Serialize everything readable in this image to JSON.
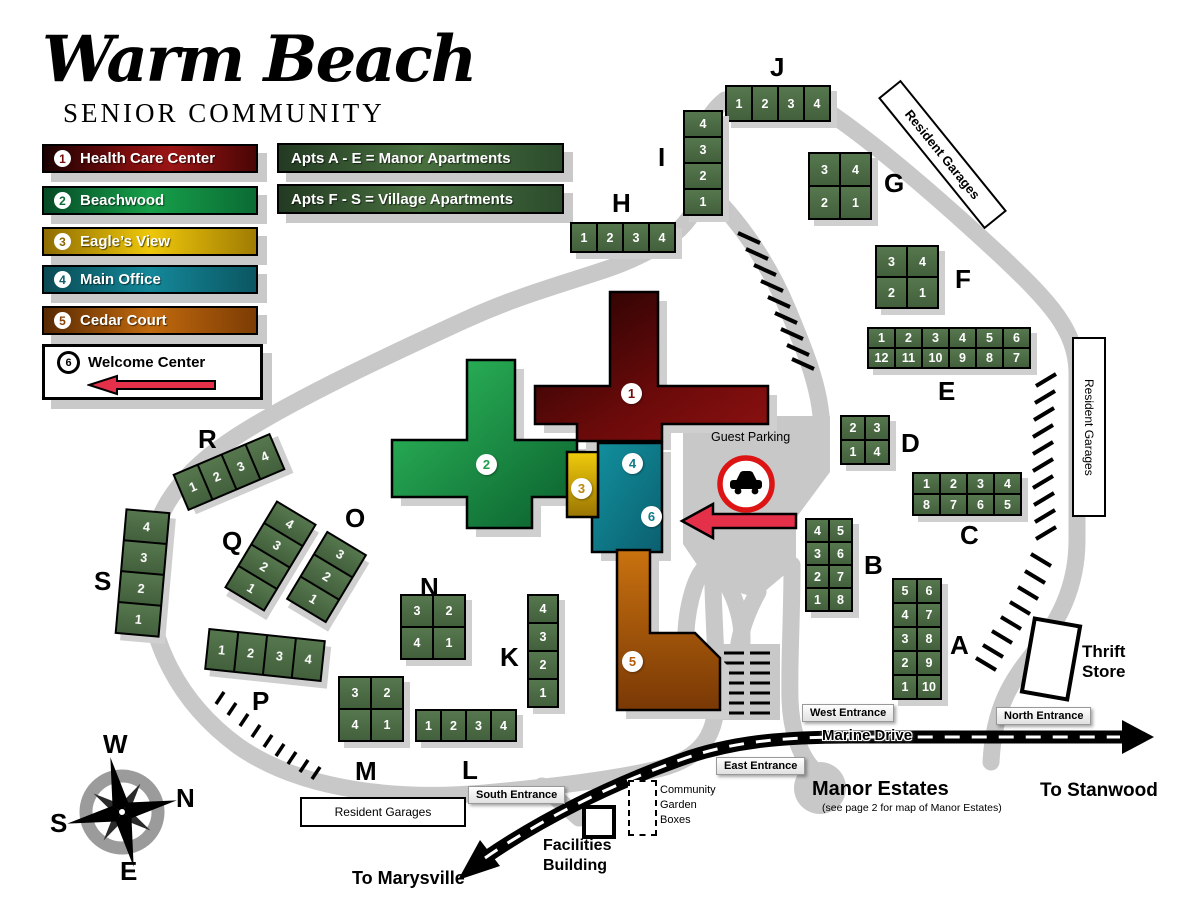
{
  "logo": {
    "title": "Warm Beach",
    "subtitle": "SENIOR COMMUNITY"
  },
  "legend": {
    "items": [
      {
        "num": "1",
        "label": "Health Care Center",
        "color": "#7a0b0b"
      },
      {
        "num": "2",
        "label": "Beachwood",
        "color": "#17a04a"
      },
      {
        "num": "3",
        "label": "Eagle’s View",
        "color": "#b8860b"
      },
      {
        "num": "4",
        "label": "Main Office",
        "color": "#0f7b8a"
      },
      {
        "num": "5",
        "label": "Cedar Court",
        "color": "#b35c0b"
      },
      {
        "num": "6",
        "label": "Welcome Center",
        "color": "#000000"
      }
    ]
  },
  "apt_keys": [
    {
      "text": "Apts A - E =  Manor Apartments"
    },
    {
      "text": "Apts F - S =  Village Apartments"
    }
  ],
  "buildings": {
    "A": {
      "letter": "A",
      "rows": [
        [
          "5",
          "6"
        ],
        [
          "4",
          "7"
        ],
        [
          "3",
          "8"
        ],
        [
          "2",
          "9"
        ],
        [
          "1",
          "10"
        ]
      ]
    },
    "B": {
      "letter": "B",
      "rows": [
        [
          "4",
          "5"
        ],
        [
          "3",
          "6"
        ],
        [
          "2",
          "7"
        ],
        [
          "1",
          "8"
        ]
      ]
    },
    "C": {
      "letter": "C",
      "rows": [
        [
          "1",
          "2",
          "3",
          "4"
        ],
        [
          "8",
          "7",
          "6",
          "5"
        ]
      ]
    },
    "D": {
      "letter": "D",
      "rows": [
        [
          "2",
          "3"
        ],
        [
          "1",
          "4"
        ]
      ]
    },
    "E": {
      "letter": "E",
      "rows": [
        [
          "1",
          "2",
          "3",
          "4",
          "5",
          "6"
        ],
        [
          "12",
          "11",
          "10",
          "9",
          "8",
          "7"
        ]
      ]
    },
    "F": {
      "letter": "F",
      "rows": [
        [
          "3",
          "4"
        ],
        [
          "2",
          "1"
        ]
      ]
    },
    "G": {
      "letter": "G",
      "rows": [
        [
          "3",
          "4"
        ],
        [
          "2",
          "1"
        ]
      ]
    },
    "H": {
      "letter": "H",
      "rows": [
        [
          "1",
          "2",
          "3",
          "4"
        ]
      ]
    },
    "I": {
      "letter": "I",
      "rows": [
        [
          "4"
        ],
        [
          "3"
        ],
        [
          "2"
        ],
        [
          "1"
        ]
      ]
    },
    "J": {
      "letter": "J",
      "rows": [
        [
          "1",
          "2",
          "3",
          "4"
        ]
      ]
    },
    "K": {
      "letter": "K",
      "rows": [
        [
          "4"
        ],
        [
          "3"
        ],
        [
          "2"
        ],
        [
          "1"
        ]
      ]
    },
    "L": {
      "letter": "L",
      "rows": [
        [
          "1",
          "2",
          "3",
          "4"
        ]
      ]
    },
    "M": {
      "letter": "M",
      "rows": [
        [
          "3",
          "2"
        ],
        [
          "4",
          "1"
        ]
      ]
    },
    "N": {
      "letter": "N",
      "rows": [
        [
          "3",
          "2"
        ],
        [
          "4",
          "1"
        ]
      ]
    },
    "O": {
      "letter": "O",
      "rows": [
        [
          "3"
        ],
        [
          "2"
        ],
        [
          "1"
        ]
      ]
    },
    "P": {
      "letter": "P",
      "rows": [
        [
          "1",
          "2",
          "3",
          "4"
        ]
      ]
    },
    "Q": {
      "letter": "Q",
      "rows": [
        [
          "4"
        ],
        [
          "3"
        ],
        [
          "2"
        ],
        [
          "1"
        ]
      ]
    },
    "R": {
      "letter": "R",
      "rows": [
        [
          "1",
          "2",
          "3",
          "4"
        ]
      ]
    },
    "S": {
      "letter": "S",
      "rows": [
        [
          "4"
        ],
        [
          "3"
        ],
        [
          "2"
        ],
        [
          "1"
        ]
      ]
    }
  },
  "markers": [
    {
      "num": "1",
      "color": "#7a0b0b"
    },
    {
      "num": "2",
      "color": "#1d9e4b"
    },
    {
      "num": "3",
      "color": "#b8860b"
    },
    {
      "num": "4",
      "color": "#0f7b8a"
    },
    {
      "num": "5",
      "color": "#b35c0b"
    },
    {
      "num": "6",
      "color": "#0f7b8a"
    }
  ],
  "map_labels": {
    "guest_parking": "Guest Parking",
    "resident_garages_top": "Resident Garages",
    "resident_garages_right": "Resident Garages",
    "resident_garages_bottom": "Resident Garages",
    "thrift_store": [
      "Thrift",
      "Store"
    ],
    "marine_drive": "Marine Drive",
    "manor_estates": "Manor Estates",
    "manor_estates_note": "(see page 2 for map of Manor Estates)",
    "to_stanwood": "To Stanwood",
    "to_marysville": "To Marysville",
    "facilities_building": [
      "Facilities",
      "Building"
    ],
    "community_garden": [
      "Community",
      "Garden",
      "Boxes"
    ]
  },
  "entrances": {
    "south": "South Entrance",
    "west": "West Entrance",
    "east": "East Entrance",
    "north": "North Entrance"
  },
  "compass": {
    "n": "N",
    "s": "S",
    "e": "E",
    "w": "W"
  }
}
